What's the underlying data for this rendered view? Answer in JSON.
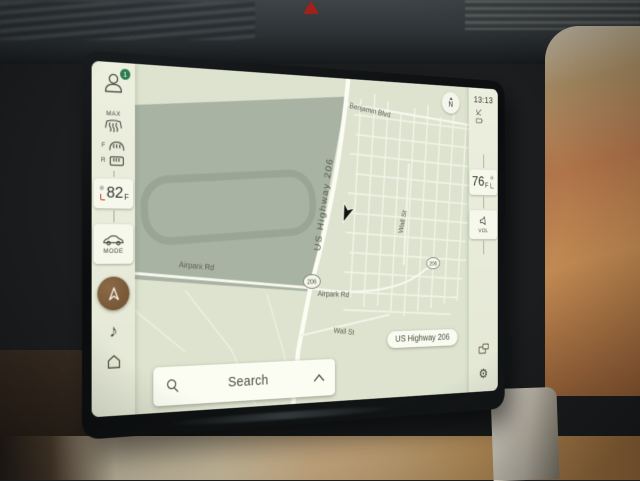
{
  "left_sidebar": {
    "profile_badge_count": "1",
    "max_defrost_label": "MAX",
    "front_defrost_label": "F",
    "rear_defrost_label": "R",
    "driver_temp": {
      "value": "82",
      "unit": "F"
    },
    "mode_label": "MODE"
  },
  "right_sidebar": {
    "time": "13:13",
    "passenger_temp": {
      "value": "76",
      "unit": "F"
    },
    "volume_label": "VOL"
  },
  "map": {
    "compass_label": "N",
    "labels": {
      "benjamin_blvd": "Benjamin Blvd",
      "us_highway_206": "US Highway 206",
      "wall_st_upper": "Wall St",
      "airpark_rd_west": "Airpark Rd",
      "airpark_rd_east": "Airpark Rd",
      "wall_st_lower": "Wall St"
    },
    "shields": {
      "main": "206",
      "east": "206"
    },
    "current_street": "US Highway 206"
  },
  "search_bar": {
    "label": "Search"
  },
  "icons": {
    "music": "♪",
    "gear": "⚙",
    "snowflake": "❄"
  },
  "colors": {
    "map_base": "#dde3cf",
    "map_terrain": "#a9b3a3",
    "sidebar": "#e9ecdb",
    "nav_accent": "#7a593a",
    "badge_green": "#2e7d4f",
    "heat_red": "#c23b2a"
  }
}
